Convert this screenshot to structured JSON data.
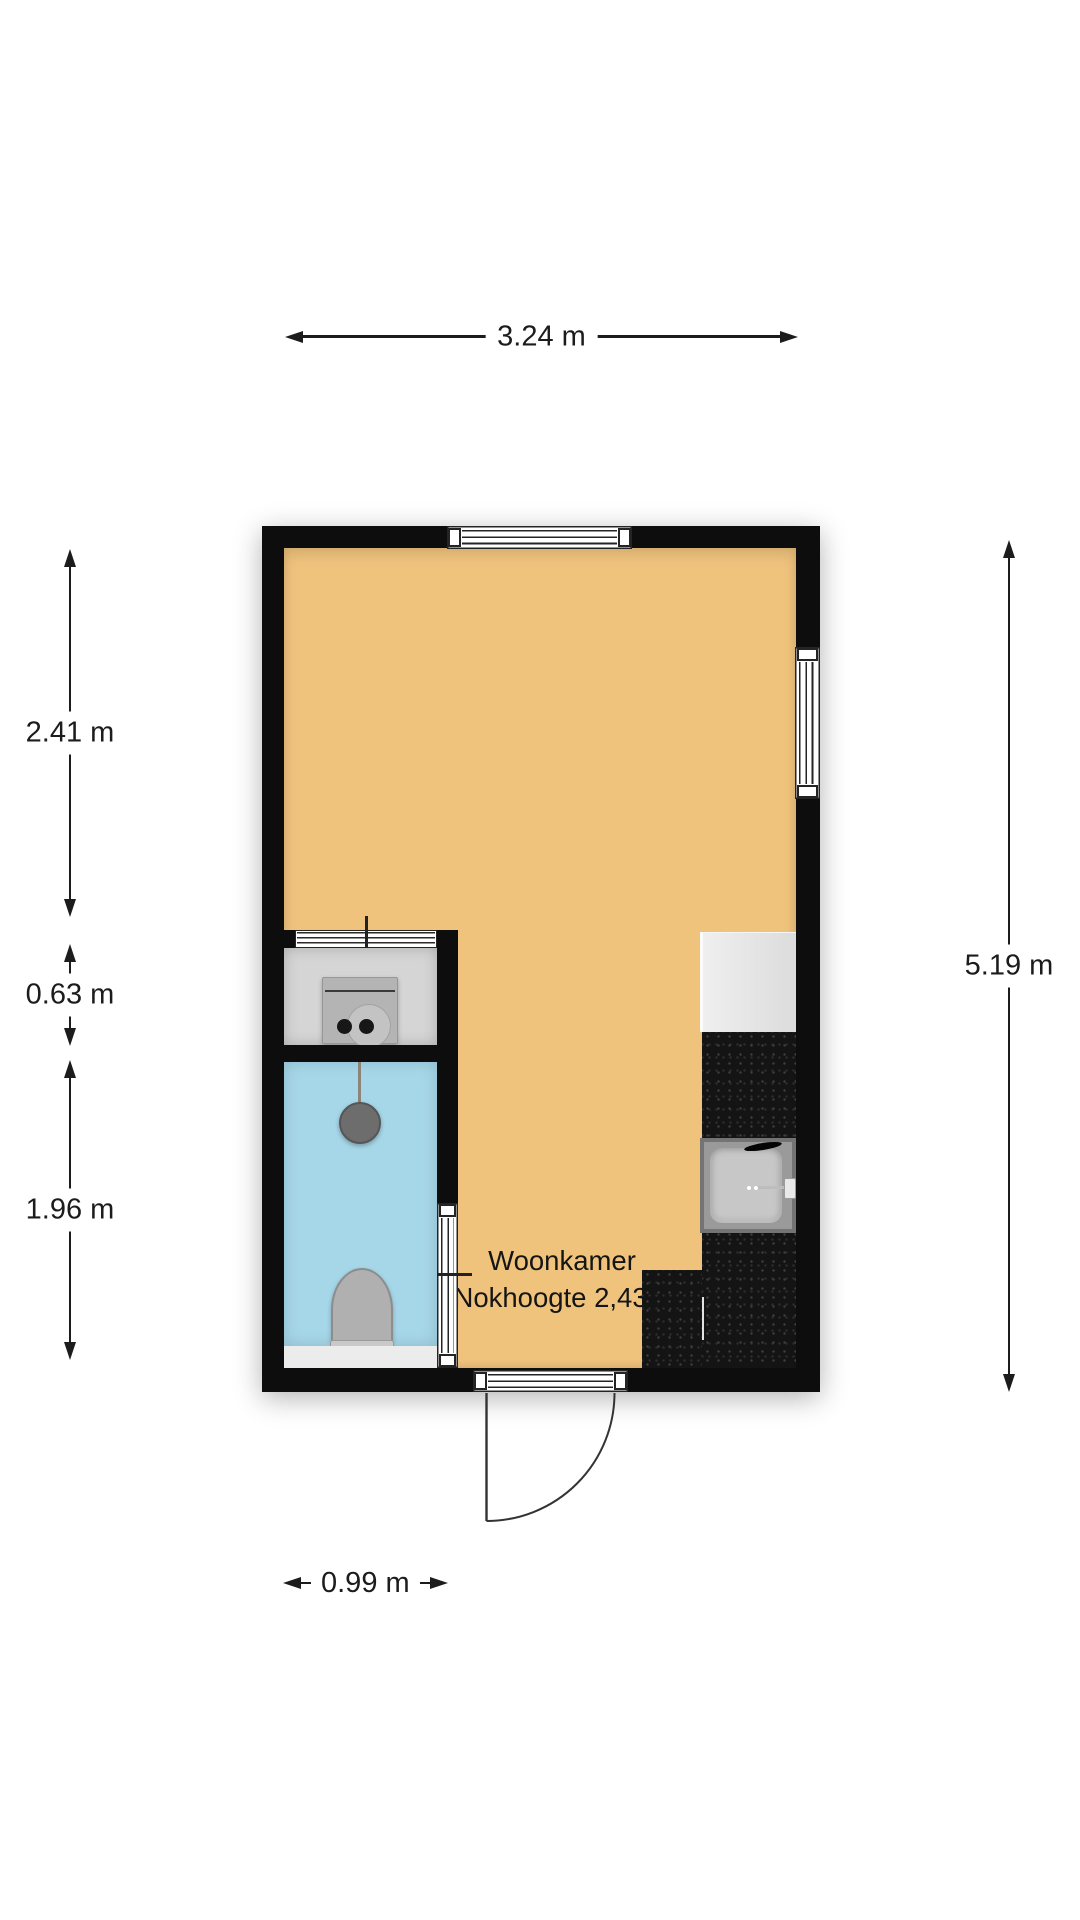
{
  "room": {
    "name": "Woonkamer",
    "height_note": "Nokhoogte 2,43m"
  },
  "dimensions": {
    "top_width": "3.24 m",
    "left_upper": "2.41 m",
    "left_middle": "0.63 m",
    "left_lower": "1.96 m",
    "right_total": "5.19 m",
    "bottom_width": "0.99 m"
  },
  "colors": {
    "floor": "#f0c37d",
    "bathroom": "#a6d7e9",
    "utility": "#d5d5d5",
    "wall": "#0d0d0d",
    "counter": "#141414",
    "dimension_text": "#1c1c1c"
  }
}
